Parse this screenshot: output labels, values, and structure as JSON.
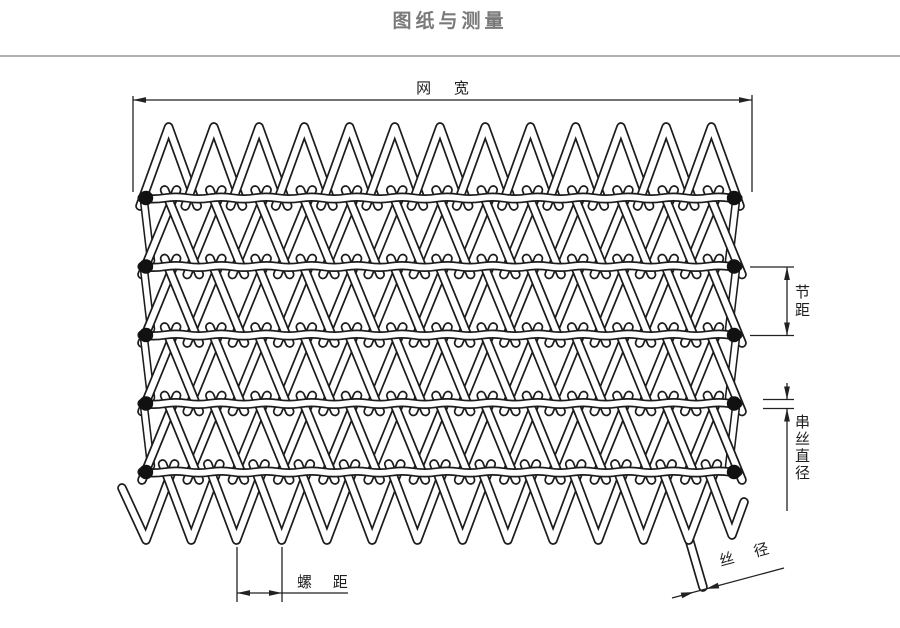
{
  "title": "图纸与测量",
  "labels": {
    "net_width": "网 宽",
    "pitch": "节距",
    "cross_wire_diameter": "串丝直径",
    "spiral_pitch": "螺 距",
    "wire_diameter": "丝 径"
  },
  "colors": {
    "wire_outline": "#1c1c1c",
    "wire_fill": "#ffffff",
    "dimension_line": "#222222",
    "title_text": "#7a7a7a",
    "divider": "#b0b0b0"
  }
}
